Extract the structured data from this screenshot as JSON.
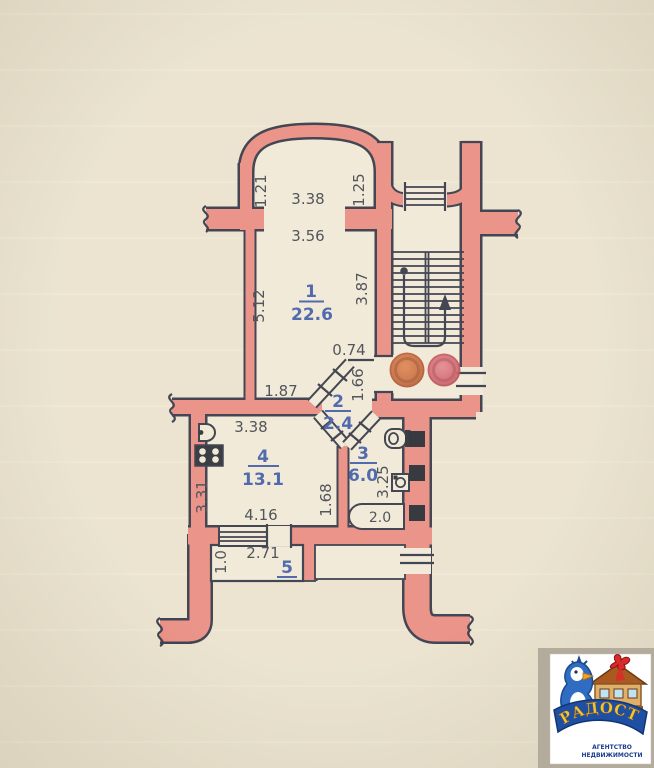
{
  "plan": {
    "dims": {
      "balcony_left": "1.21",
      "balcony_width": "3.38",
      "balcony_right": "1.25",
      "room1_width": "3.56",
      "room1_left": "5.12",
      "room1_right": "3.87",
      "hall_top": "0.74",
      "room1_bottom": "1.87",
      "hall_right": "1.66",
      "kitchen_top": "3.38",
      "kitchen_left": "3.31",
      "kitchen_right": "1.68",
      "kitchen_bottom": "4.16",
      "bath_right": "3.25",
      "bathtub": "2.0",
      "balcony5_left": "1.0",
      "balcony5_width": "2.71"
    },
    "rooms": [
      {
        "number": "1",
        "area": "22.6"
      },
      {
        "number": "2",
        "area": "2.4"
      },
      {
        "number": "3",
        "area": "6.0"
      },
      {
        "number": "4",
        "area": "13.1"
      },
      {
        "number": "5",
        "area": ""
      }
    ]
  },
  "logo": {
    "brand": "РАДОСТЬ",
    "line1": "АГЕНТСТВО",
    "line2": "НЕДВИЖИМОСТИ"
  },
  "colors": {
    "wall": "#e8867c",
    "outline": "#2a2d3d",
    "label_blue": "#3a57a5",
    "dim_text": "#3b3e48",
    "stamp_orange": "#c05a2e",
    "stamp_red": "#cf5560"
  }
}
